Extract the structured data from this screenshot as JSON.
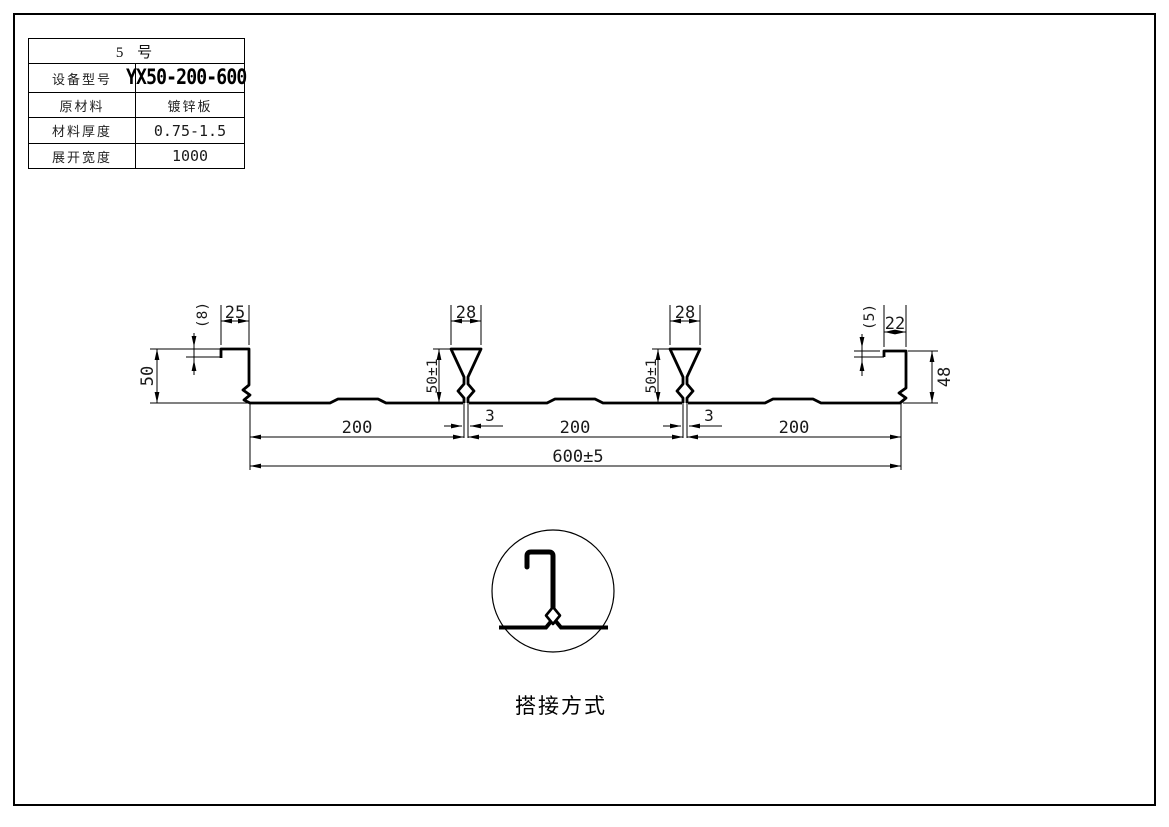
{
  "spec_table": {
    "header": "5 号",
    "rows": [
      {
        "label": "设备型号",
        "value": "YX50-200-600"
      },
      {
        "label": "原材料",
        "value": "镀锌板"
      },
      {
        "label": "材料厚度",
        "value": "0.75-1.5"
      },
      {
        "label": "展开宽度",
        "value": "1000"
      }
    ]
  },
  "drawing": {
    "dims": {
      "left_height": "50",
      "left_lip": "(8)",
      "left_top_width": "25",
      "rib_top_width": "28",
      "rib_height": "50±1",
      "rib_slot_width": "3",
      "right_lip": "(5)",
      "right_top_width": "22",
      "right_height": "48",
      "pitch": "200",
      "overall_width": "600±5"
    },
    "detail_label": "搭接方式",
    "line_color": "#000000"
  }
}
